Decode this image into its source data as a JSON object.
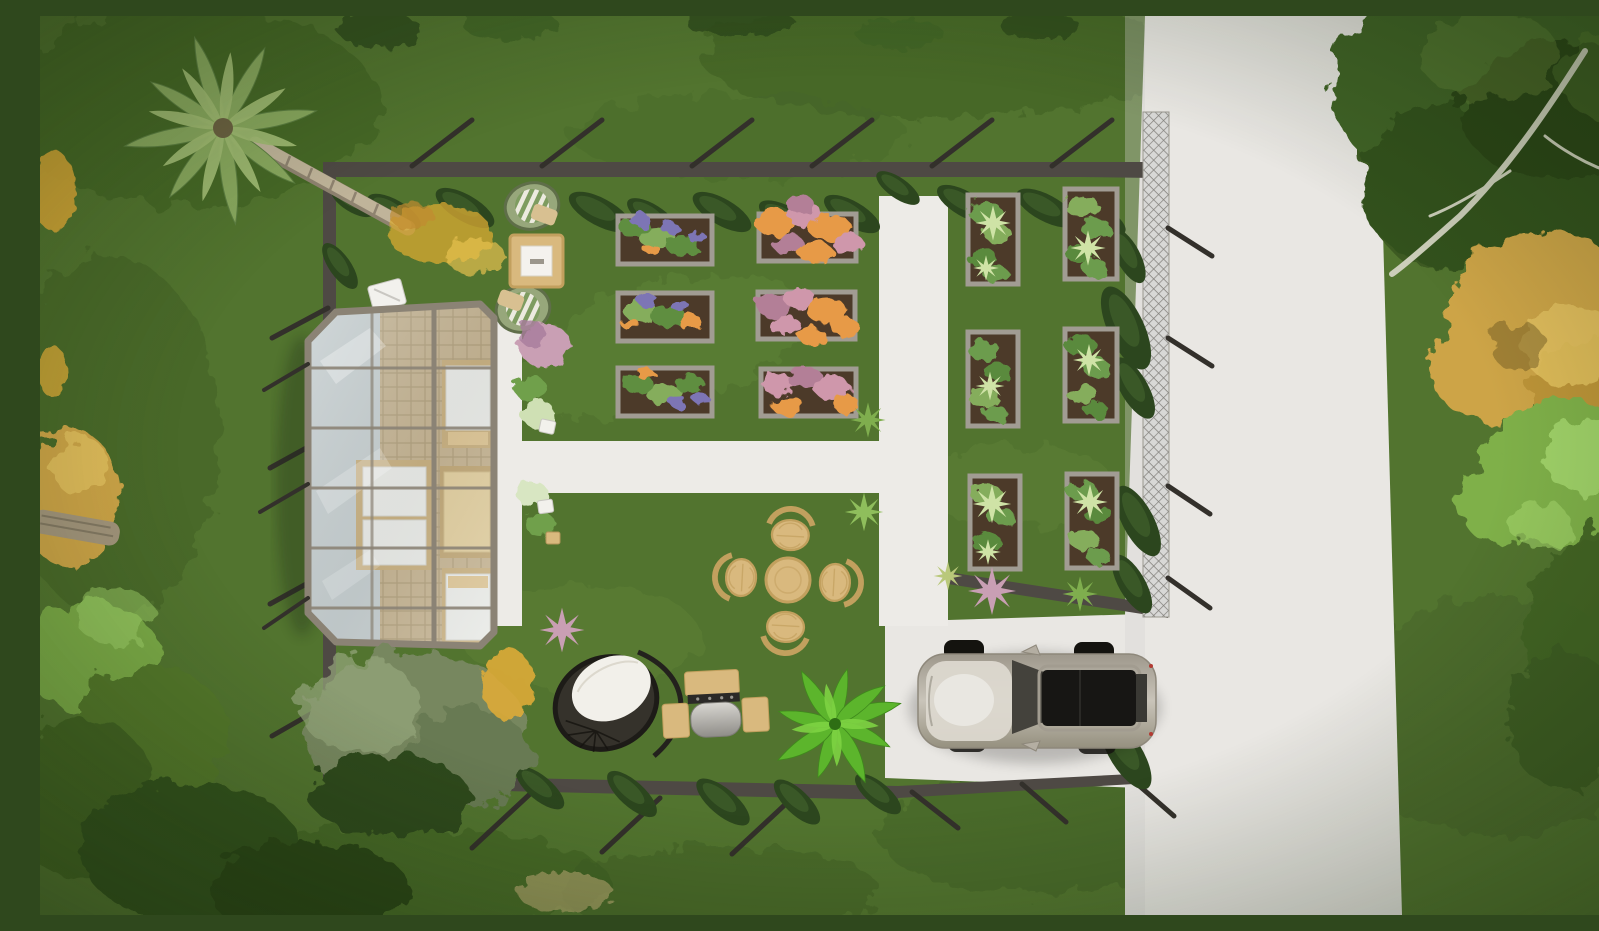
{
  "scene": {
    "title": "Aerial top-down 3D rendering of a landscaped backyard garden with glass garden room, raised planting beds, white paths and a parked SUV",
    "view": "top-down aerial",
    "style": "photorealistic architectural visualization"
  },
  "palette": {
    "grass-base": "#52742f",
    "grass-dark": "#3c5a22",
    "grass-mid": "#486a29",
    "grass-light": "#7da04c",
    "road": "#e9e7e3",
    "path": "#edebe7",
    "fence": "#4e4944",
    "fence-post": "#33302b",
    "mesh-light": "#d8d8d6",
    "mesh-dark": "#83817c",
    "cypress": "#2c461e",
    "cypress-lt": "#3f5f2b",
    "shrub-dark": "#2f481d",
    "bed-frame": "#a19c93",
    "soil": "#4c3a29",
    "leaf-green": "#5f8e41",
    "leaf-light": "#85ad5b",
    "flower-orange": "#e79a47",
    "flower-pink": "#cf97ab",
    "flower-mauve": "#b37f97",
    "flower-purple": "#7d74b5",
    "veg-green": "#6c9c4d",
    "veg-pale": "#cfe3a6",
    "gh-frame": "#8b8375",
    "glass-hi": "#dfe7ea",
    "glass-lo": "#9fadb3",
    "wood": "#d9b97e",
    "wood-dark": "#c2a05e",
    "cushion": "#f2f0ea",
    "stripe-green": "#7e9c60",
    "sage": "#77875f",
    "sage-light": "#96a67c",
    "palm-1": "#8aa95f",
    "palm-2": "#a3bd74",
    "trunk": "#c0b49a",
    "gold": "#cda446",
    "gold-light": "#e3c15f",
    "bright-green": "#7fb04a",
    "bright-light": "#a3d56b",
    "canopy-dark": "#33511d",
    "canopy-mid": "#406325",
    "branch": "#ccceba",
    "car-body": "#b4aea2",
    "car-hood": "#dcd8cf",
    "car-roof": "#171614",
    "car-glass": "#44423c",
    "pink-grass": "#c99fb4",
    "yellow-flower": "#ddab38",
    "palm-plant": "#5cb52c",
    "litter": "#d9a933"
  },
  "objects": [
    {
      "name": "palm-tree",
      "label": "Leaning palm tree at garden corner"
    },
    {
      "name": "greenhouse",
      "label": "Glass garden room with daybeds"
    },
    {
      "name": "flower-beds",
      "label": "Six raised flower beds (purple, orange, pink blooms)"
    },
    {
      "name": "vegetable-beds",
      "label": "Six raised vegetable beds"
    },
    {
      "name": "dining-set",
      "label": "Round wicker dining table with four chairs"
    },
    {
      "name": "lounge-corner",
      "label": "Two rattan lounge chairs with square coffee table"
    },
    {
      "name": "hanging-egg-chair",
      "label": "Black wicker hanging egg chair with white cushion"
    },
    {
      "name": "bbq-grill",
      "label": "Barbecue grill trolley with wood shelves"
    },
    {
      "name": "fan-palm-plant",
      "label": "Bright green fan palm shrub"
    },
    {
      "name": "car",
      "label": "Champagne-silver SUV parked on driveway"
    },
    {
      "name": "road",
      "label": "White concrete road on the right"
    },
    {
      "name": "driveway",
      "label": "White parking pad and garden paths"
    },
    {
      "name": "garden-fence",
      "label": "Dark garden walls with angled braces"
    },
    {
      "name": "mesh-fence",
      "label": "Chain-link fence panel along the road"
    },
    {
      "name": "cypress-hedge",
      "label": "Young cypress trees along the walls"
    },
    {
      "name": "right-trees",
      "label": "Green, golden and lime tree canopies along road"
    },
    {
      "name": "sage-bush",
      "label": "Large sage-green shrub below greenhouse"
    }
  ],
  "counts": {
    "flower_beds": 6,
    "vegetable_beds": 6,
    "dining_chairs": 4,
    "daybeds": 3,
    "lounge_chairs": 2,
    "cars": 1
  }
}
